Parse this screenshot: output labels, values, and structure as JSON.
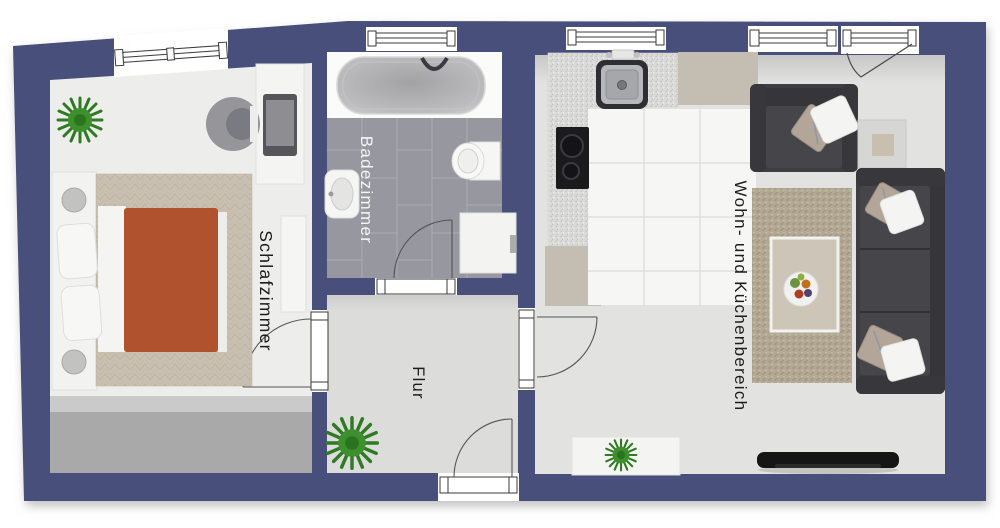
{
  "rooms": {
    "schlafzimmer": {
      "label": "Schlafzimmer"
    },
    "badezimmer": {
      "label": "Badezimmer"
    },
    "flur": {
      "label": "Flur"
    },
    "wohn_kueche": {
      "label": "Wohn- und Küchenbereich"
    }
  },
  "colors": {
    "wall": "#46507A",
    "bedroom_floor": "#EDEDEB",
    "bath_tile": "#96979F",
    "hall_floor": "#DCDCDB",
    "living_floor": "#E2E2E0",
    "kitchen_tile": "#F6F6F4",
    "counter_beige": "#C4BEB2",
    "blanket": "#B1522F",
    "sofa": "#3E3E42",
    "rug": "#B2A794",
    "plant": "#3E8F2E",
    "tv": "#151515",
    "label_dark": "#1C1C1C",
    "label_light": "#F5F5F3"
  }
}
